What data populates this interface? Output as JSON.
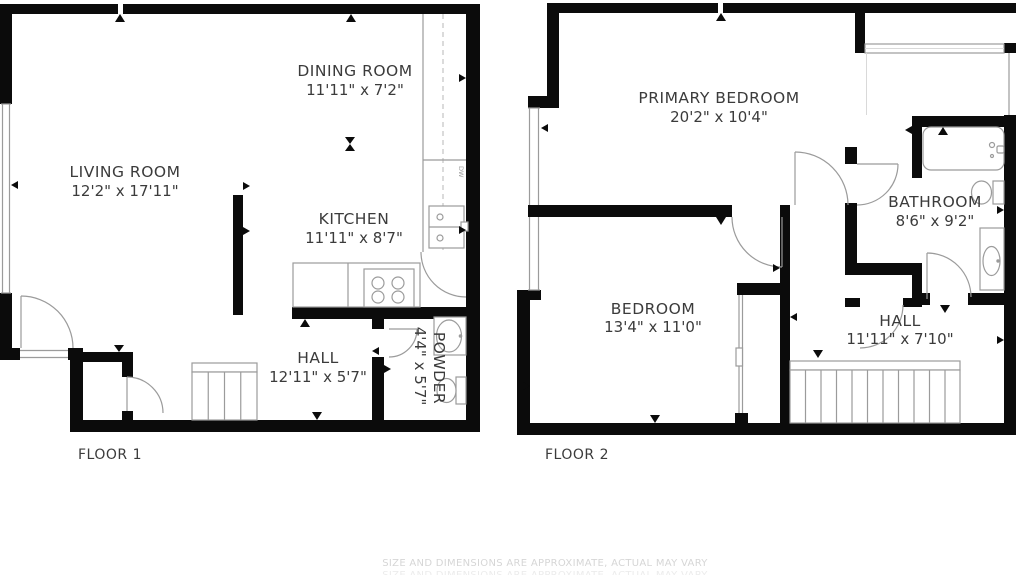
{
  "floor1": {
    "label": "FLOOR 1",
    "rooms": [
      {
        "name": "LIVING ROOM",
        "dims": "12'2\" x 17'11\""
      },
      {
        "name": "DINING ROOM",
        "dims": "11'11\" x 7'2\""
      },
      {
        "name": "KITCHEN",
        "dims": "11'11\" x 8'7\""
      },
      {
        "name": "HALL",
        "dims": "12'11\" x 5'7\""
      },
      {
        "name": "POWDER",
        "dims": "4'4\" x 5'7\""
      }
    ],
    "appliances": {
      "dishwasher": "DW"
    }
  },
  "floor2": {
    "label": "FLOOR 2",
    "rooms": [
      {
        "name": "PRIMARY BEDROOM",
        "dims": "20'2\" x 10'4\""
      },
      {
        "name": "BEDROOM",
        "dims": "13'4\" x 11'0\""
      },
      {
        "name": "BATHROOM",
        "dims": "8'6\" x 9'2\""
      },
      {
        "name": "HALL",
        "dims": "11'11\" x 7'10\""
      }
    ]
  },
  "footer": {
    "disclaimer": "SIZE AND DIMENSIONS ARE APPROXIMATE, ACTUAL MAY VARY"
  },
  "colors": {
    "wall": "#0b0b0b",
    "fixture_line": "#9b9b9b",
    "text": "#3b3b3b",
    "disclaimer_text": "#d6d6d6",
    "background": "#ffffff"
  }
}
